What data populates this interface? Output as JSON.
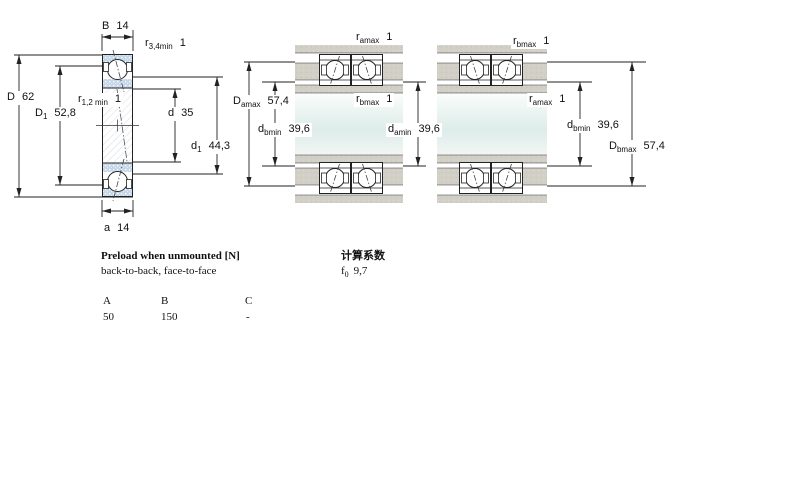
{
  "drawing": {
    "left": {
      "dims": {
        "B": {
          "base": "B",
          "sub": "",
          "value": "14"
        },
        "r34": {
          "base": "r",
          "sub": "3,4min",
          "value": "1"
        },
        "D": {
          "base": "D",
          "sub": "",
          "value": "62"
        },
        "r12": {
          "base": "r",
          "sub": "1,2 min",
          "value": "1"
        },
        "D1": {
          "base": "D",
          "sub": "1",
          "value": "52,8"
        },
        "d": {
          "base": "d",
          "sub": "",
          "value": "35"
        },
        "d1": {
          "base": "d",
          "sub": "1",
          "value": "44,3"
        },
        "a": {
          "base": "a",
          "sub": "",
          "value": "14"
        }
      }
    },
    "middle": {
      "dims": {
        "ramax": {
          "base": "r",
          "sub": "amax",
          "value": "1"
        },
        "Damax": {
          "base": "D",
          "sub": "amax",
          "value": "57,4"
        },
        "rbmax": {
          "base": "r",
          "sub": "bmax",
          "value": "1"
        },
        "dbmin": {
          "base": "d",
          "sub": "bmin",
          "value": "39,6"
        },
        "damin": {
          "base": "d",
          "sub": "amin",
          "value": "39,6"
        }
      }
    },
    "right": {
      "dims": {
        "rbmax": {
          "base": "r",
          "sub": "bmax",
          "value": "1"
        },
        "ramax": {
          "base": "r",
          "sub": "amax",
          "value": "1"
        },
        "dbmin": {
          "base": "d",
          "sub": "bmin",
          "value": "39,6"
        },
        "Dbmax": {
          "base": "D",
          "sub": "bmax",
          "value": "57,4"
        }
      }
    }
  },
  "preload": {
    "title": "Preload when unmounted [N]",
    "subtitle": "back-to-back, face-to-face",
    "columns": [
      "A",
      "B",
      "C"
    ],
    "values": [
      "50",
      "150",
      "-"
    ]
  },
  "calculation": {
    "title": "计算系数",
    "factor": {
      "base": "f",
      "sub": "0",
      "value": "9,7"
    }
  },
  "colors": {
    "bearing_blue": "#c7d7ea",
    "housing_gray": "#d2cfc7",
    "shaft_tint": "#ddecea",
    "line": "#222222"
  }
}
